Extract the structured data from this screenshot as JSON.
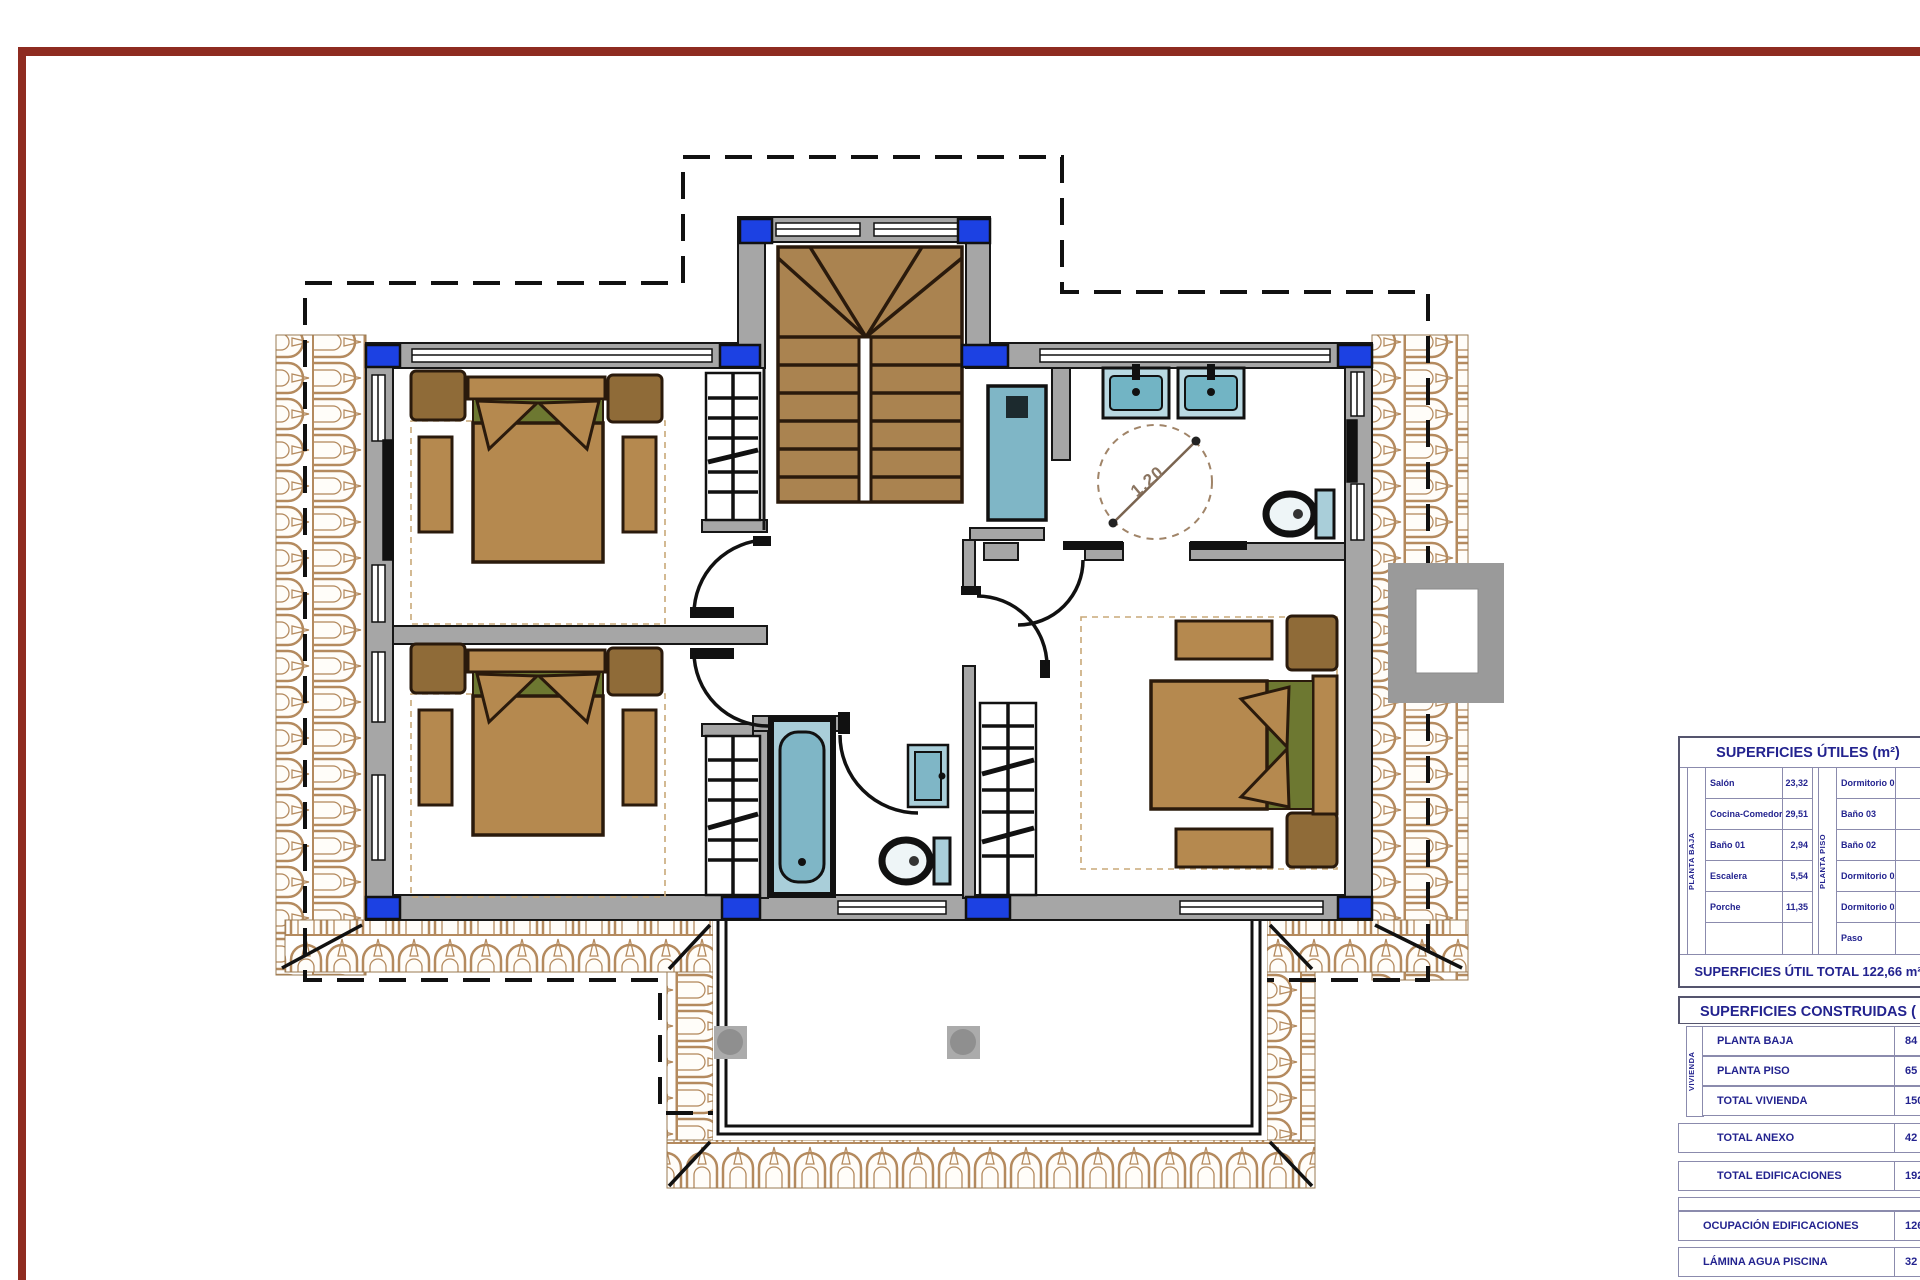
{
  "plan": {
    "turning_circle_label": "1.20",
    "colors": {
      "frame_red": "#8e2b20",
      "wall_gray": "#a6a6a6",
      "column_blue": "#1c41e3",
      "stair_brown": "#aa8350",
      "furniture_brown": "#b5894f",
      "furniture_dark_brown": "#8f6b38",
      "pillow_green": "#6d7831",
      "fixture_cyan": "#7fb6c6",
      "fixture_cyan_light": "#a9ced9",
      "tile_tan": "#b48a5e",
      "text_navy": "#23238f"
    }
  },
  "tables": {
    "utiles": {
      "title": "SUPERFICIES ÚTILES (m²)",
      "group_left_label": "PLANTA BAJA",
      "group_right_label": "PLANTA PISO",
      "left_rows": [
        {
          "label": "Salón",
          "value": "23,32"
        },
        {
          "label": "Cocina-Comedor",
          "value": "29,51"
        },
        {
          "label": "Baño 01",
          "value": "2,94"
        },
        {
          "label": "Escalera",
          "value": "5,54"
        },
        {
          "label": "Porche",
          "value": "11,35"
        },
        {
          "label": "",
          "value": ""
        }
      ],
      "right_rows": [
        {
          "label": "Dormitorio 01",
          "value": ""
        },
        {
          "label": "Baño 03",
          "value": ""
        },
        {
          "label": "Baño 02",
          "value": ""
        },
        {
          "label": "Dormitorio 02",
          "value": ""
        },
        {
          "label": "Dormitorio 03",
          "value": ""
        },
        {
          "label": "Paso",
          "value": ""
        }
      ],
      "total": "SUPERFICIES ÚTIL TOTAL 122,66 m²"
    },
    "construidas": {
      "title": "SUPERFICIES CONSTRUIDAS (",
      "group_label": "VIVIENDA",
      "rows": [
        {
          "label": "PLANTA BAJA",
          "value": "84"
        },
        {
          "label": "PLANTA PISO",
          "value": "65"
        },
        {
          "label": "TOTAL VIVIENDA",
          "value": "150"
        },
        {
          "label": "TOTAL ANEXO",
          "value": "42"
        },
        {
          "label": "TOTAL EDIFICACIONES",
          "value": "192"
        },
        {
          "label": "OCUPACIÓN EDIFICACIONES",
          "value": "126"
        },
        {
          "label": "LÁMINA AGUA PISCINA",
          "value": "32"
        }
      ]
    }
  }
}
